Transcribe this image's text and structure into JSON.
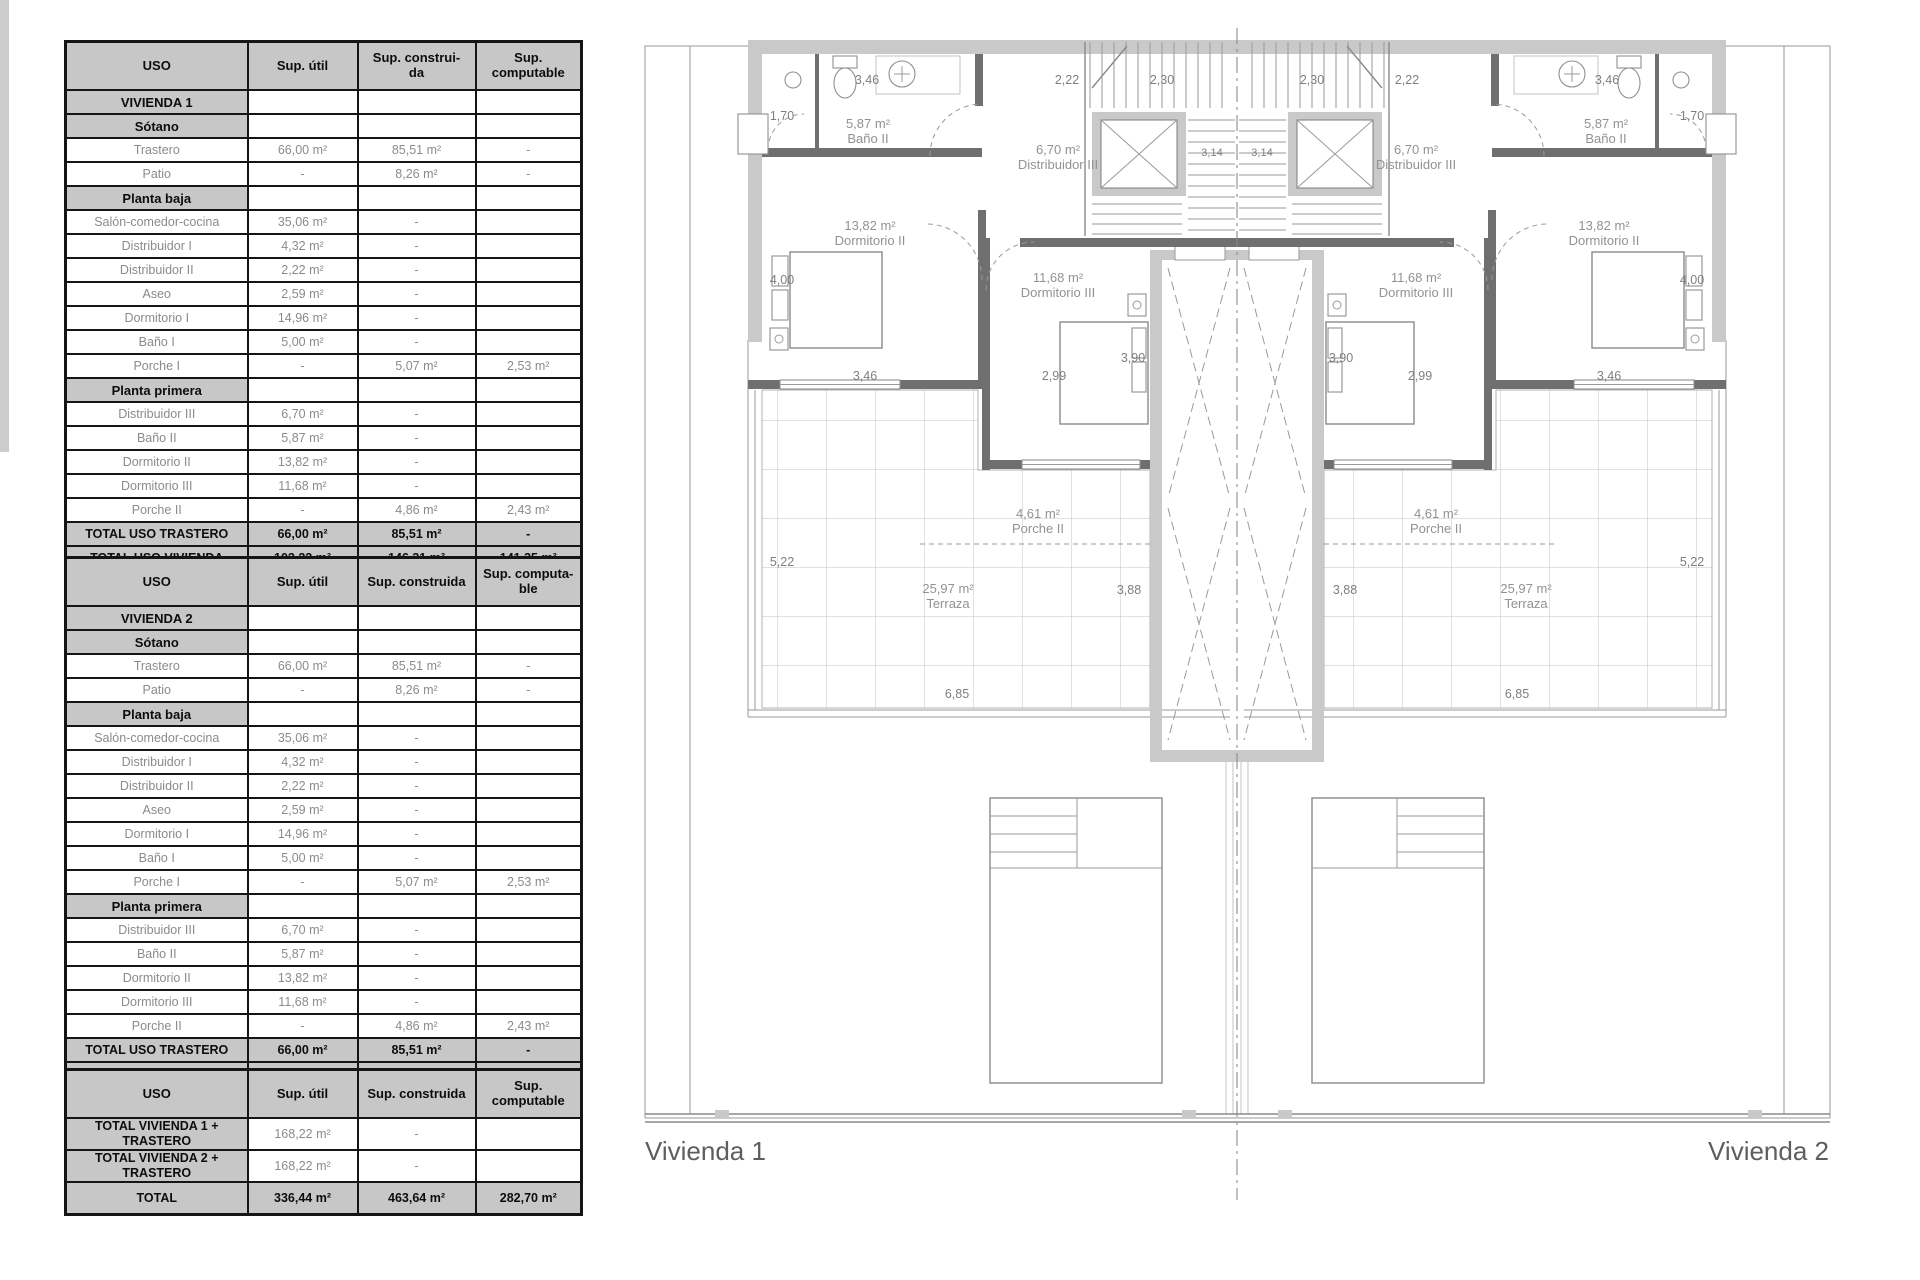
{
  "tables": [
    {
      "title": "VIVIENDA 1",
      "headers": [
        "USO",
        "Sup. útil",
        "Sup. construi-\nda",
        "Sup. computable"
      ],
      "rows": [
        {
          "type": "section",
          "label": "VIVIENDA 1",
          "util": "",
          "construida": "",
          "computable": ""
        },
        {
          "type": "section",
          "label": "Sótano",
          "util": "",
          "construida": "",
          "computable": ""
        },
        {
          "type": "data",
          "label": "Trastero",
          "util": "66,00 m²",
          "construida": "85,51 m²",
          "computable": "-"
        },
        {
          "type": "data",
          "label": "Patio",
          "util": "-",
          "construida": "8,26 m²",
          "computable": "-"
        },
        {
          "type": "section",
          "label": "Planta baja",
          "util": "",
          "construida": "",
          "computable": ""
        },
        {
          "type": "data",
          "label": "Salón-comedor-cocina",
          "util": "35,06 m²",
          "construida": "-",
          "computable": ""
        },
        {
          "type": "data",
          "label": "Distribuidor I",
          "util": "4,32 m²",
          "construida": "-",
          "computable": ""
        },
        {
          "type": "data",
          "label": "Distribuidor II",
          "util": "2,22 m²",
          "construida": "-",
          "computable": ""
        },
        {
          "type": "data",
          "label": "Aseo",
          "util": "2,59 m²",
          "construida": "-",
          "computable": ""
        },
        {
          "type": "data",
          "label": "Dormitorio I",
          "util": "14,96 m²",
          "construida": "-",
          "computable": ""
        },
        {
          "type": "data",
          "label": "Baño I",
          "util": "5,00 m²",
          "construida": "-",
          "computable": ""
        },
        {
          "type": "data",
          "label": "Porche I",
          "util": "-",
          "construida": "5,07 m²",
          "computable": "2,53 m²"
        },
        {
          "type": "section",
          "label": "Planta primera",
          "util": "",
          "construida": "",
          "computable": ""
        },
        {
          "type": "data",
          "label": "Distribuidor III",
          "util": "6,70 m²",
          "construida": "-",
          "computable": ""
        },
        {
          "type": "data",
          "label": "Baño II",
          "util": "5,87 m²",
          "construida": "-",
          "computable": ""
        },
        {
          "type": "data",
          "label": "Dormitorio II",
          "util": "13,82 m²",
          "construida": "-",
          "computable": ""
        },
        {
          "type": "data",
          "label": "Dormitorio III",
          "util": "11,68 m²",
          "construida": "-",
          "computable": ""
        },
        {
          "type": "data",
          "label": "Porche II",
          "util": "-",
          "construida": "4,86 m²",
          "computable": "2,43 m²"
        },
        {
          "type": "total",
          "label": "TOTAL USO TRASTERO",
          "util": "66,00 m²",
          "construida": "85,51 m²",
          "computable": "-"
        },
        {
          "type": "total",
          "label": "TOTAL USO VIVIENDA",
          "util": "102,22 m²",
          "construida": "146,31 m²",
          "computable": "141,35 m²"
        }
      ]
    },
    {
      "title": "VIVIENDA 2",
      "headers": [
        "USO",
        "Sup. útil",
        "Sup. construida",
        "Sup. computa-\nble"
      ],
      "rows": [
        {
          "type": "section",
          "label": "VIVIENDA 2",
          "util": "",
          "construida": "",
          "computable": ""
        },
        {
          "type": "section",
          "label": "Sótano",
          "util": "",
          "construida": "",
          "computable": ""
        },
        {
          "type": "data",
          "label": "Trastero",
          "util": "66,00 m²",
          "construida": "85,51 m²",
          "computable": "-"
        },
        {
          "type": "data",
          "label": "Patio",
          "util": "-",
          "construida": "8,26 m²",
          "computable": "-"
        },
        {
          "type": "section",
          "label": "Planta baja",
          "util": "",
          "construida": "",
          "computable": ""
        },
        {
          "type": "data",
          "label": "Salón-comedor-cocina",
          "util": "35,06 m²",
          "construida": "-",
          "computable": ""
        },
        {
          "type": "data",
          "label": "Distribuidor I",
          "util": "4,32 m²",
          "construida": "-",
          "computable": ""
        },
        {
          "type": "data",
          "label": "Distribuidor II",
          "util": "2,22 m²",
          "construida": "-",
          "computable": ""
        },
        {
          "type": "data",
          "label": "Aseo",
          "util": "2,59 m²",
          "construida": "-",
          "computable": ""
        },
        {
          "type": "data",
          "label": "Dormitorio I",
          "util": "14,96 m²",
          "construida": "-",
          "computable": ""
        },
        {
          "type": "data",
          "label": "Baño I",
          "util": "5,00 m²",
          "construida": "-",
          "computable": ""
        },
        {
          "type": "data",
          "label": "Porche I",
          "util": "-",
          "construida": "5,07 m²",
          "computable": "2,53 m²"
        },
        {
          "type": "section",
          "label": "Planta primera",
          "util": "",
          "construida": "",
          "computable": ""
        },
        {
          "type": "data",
          "label": "Distribuidor III",
          "util": "6,70 m²",
          "construida": "-",
          "computable": ""
        },
        {
          "type": "data",
          "label": "Baño II",
          "util": "5,87 m²",
          "construida": "-",
          "computable": ""
        },
        {
          "type": "data",
          "label": "Dormitorio II",
          "util": "13,82 m²",
          "construida": "-",
          "computable": ""
        },
        {
          "type": "data",
          "label": "Dormitorio III",
          "util": "11,68 m²",
          "construida": "-",
          "computable": ""
        },
        {
          "type": "data",
          "label": "Porche II",
          "util": "-",
          "construida": "4,86 m²",
          "computable": "2,43 m²"
        },
        {
          "type": "total",
          "label": "TOTAL USO TRASTERO",
          "util": "66,00 m²",
          "construida": "85,51 m²",
          "computable": "-"
        },
        {
          "type": "total",
          "label": "TOTAL USO VIVIENDA",
          "util": "102,22 m²",
          "construida": "146,31 m²",
          "computable": "141,35 m²"
        }
      ]
    },
    {
      "title": "TOTALES",
      "headers": [
        "USO",
        "Sup. útil",
        "Sup. construida",
        "Sup. computable"
      ],
      "rows": [
        {
          "type": "total2",
          "label": "TOTAL VIVIENDA 1 + TRASTERO",
          "util": "168,22 m²",
          "construida": "-",
          "computable": ""
        },
        {
          "type": "total2",
          "label": "TOTAL VIVIENDA 2 + TRASTERO",
          "util": "168,22 m²",
          "construida": "-",
          "computable": ""
        },
        {
          "type": "total",
          "label": "TOTAL",
          "util": "336,44 m²",
          "construida": "463,64  m²",
          "computable": "282,70  m²"
        }
      ]
    }
  ],
  "plan": {
    "captions": {
      "left": "Vivienda 1",
      "right": "Vivienda 2"
    },
    "rooms": {
      "bano2": {
        "area": "5,87 m²",
        "name": "Baño II"
      },
      "distribuidor3": {
        "area": "6,70 m²",
        "name": "Distribuidor III"
      },
      "dormitorio2": {
        "area": "13,82 m²",
        "name": "Dormitorio II"
      },
      "dormitorio3": {
        "area": "11,68 m²",
        "name": "Dormitorio III"
      },
      "porche2": {
        "area": "4,61 m²",
        "name": "Porche II"
      },
      "terraza": {
        "area": "25,97 m²",
        "name": "Terraza"
      }
    },
    "dims": {
      "d346": "3,46",
      "d222": "2,22",
      "d230": "2,30",
      "d170": "1,70",
      "d400": "4,00",
      "d314": "3,14",
      "d299": "2,99",
      "d390": "3,90",
      "d522": "5,22",
      "d388": "3,88",
      "d685": "6,85"
    }
  }
}
